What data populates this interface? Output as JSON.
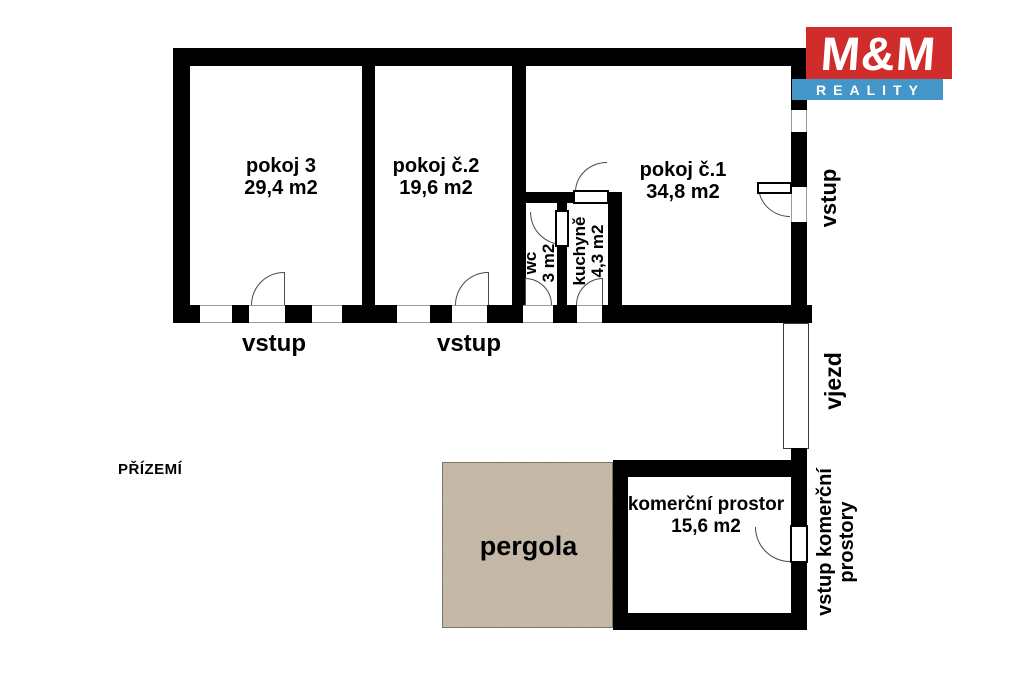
{
  "floor_label": "PŘÍZEMÍ",
  "logo": {
    "brand": "M&M",
    "tagline": "REALITY",
    "brand_bg": "#d02c2c",
    "tagline_bg": "#4495c8"
  },
  "rooms": {
    "pokoj3": {
      "name": "pokoj 3",
      "area": "29,4 m2"
    },
    "pokoj2": {
      "name": "pokoj č.2",
      "area": "19,6 m2"
    },
    "pokoj1": {
      "name": "pokoj č.1",
      "area": "34,8 m2"
    },
    "wc": {
      "name": "wc",
      "area": "3 m2"
    },
    "kuchyne": {
      "name": "kuchyně",
      "area": "4,3 m2"
    },
    "komercni": {
      "name": "komerční prostor",
      "area": "15,6 m2"
    },
    "pergola": {
      "name": "pergola"
    }
  },
  "entrances": {
    "vstup_pokoj3": "vstup",
    "vstup_pokoj2": "vstup",
    "vstup_pokoj1": "vstup",
    "vjezd": "vjezd",
    "vstup_komercni_line1": "vstup komerční",
    "vstup_komercni_line2": "prostory"
  },
  "colors": {
    "wall": "#000000",
    "pergola_fill": "#c9bcab"
  }
}
